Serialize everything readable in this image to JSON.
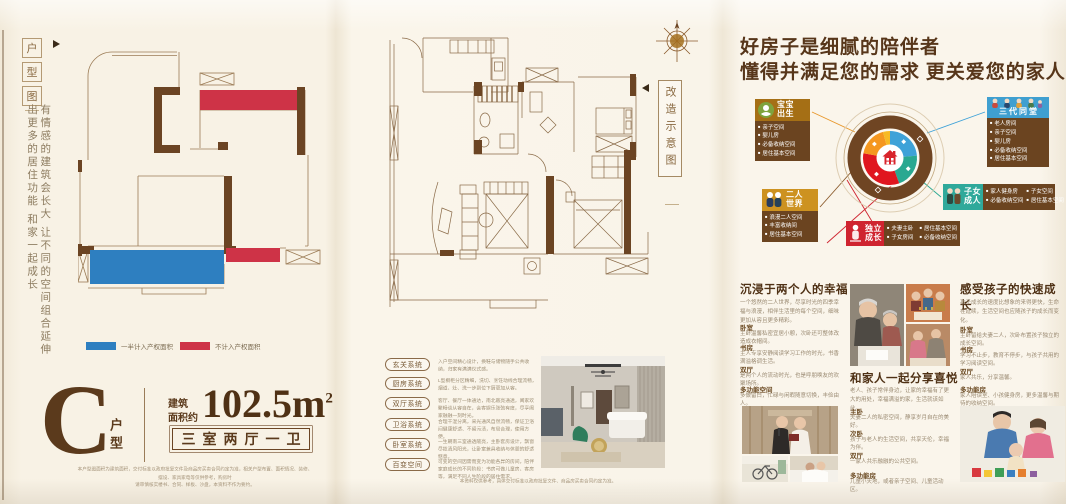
{
  "left_panel": {
    "tab_chars": [
      "户",
      "型",
      "图"
    ],
    "intro_vertical": "有情感的建筑会长大 让不同的空间组合延伸出更多的居住功能 和家一起成长",
    "legend": [
      {
        "color": "#2e7fc0",
        "label": "一半计入产权面积"
      },
      {
        "color": "#ce3347",
        "label": "不计入产权面积"
      }
    ],
    "unit_letter": "C",
    "unit_suffix": "户型",
    "area_label_1": "建筑",
    "area_label_2": "面积约",
    "area_value": "102.5m",
    "area_sup": "2",
    "rooms_label": "三室两厅一卫",
    "disclaimer_1": "本户型图面积为建筑面积，交付标准以政府批复文件及商品房买卖合同约定为准，相关户型布置、面积情况、装修、摆设、家具家电等仅供参考，购房时",
    "disclaimer_2": "请审慎核实楼书、合同、样板、沙盘，本资料不作为要约。"
  },
  "middle_panel": {
    "tab_chars": [
      "改",
      "造",
      "示",
      "意",
      "图"
    ],
    "systems": [
      {
        "name": "玄关系统",
        "desc": "入户空间精心设计，换鞋与储物随手公共收纳，归家有满满仪式感。"
      },
      {
        "name": "厨房系统",
        "desc": "L型橱柜分区精细，洗切、烹饪动线合理流畅，烟道、灶、洗一步到位下厨更加从容。"
      },
      {
        "name": "双厅系统",
        "desc": "客厅、餐厅一体通达，南北敞亮通透，阖家欢聚畅谈从容自在，会客娱乐张弛有度，尽享阖家融融一刻时光。"
      },
      {
        "name": "卫浴系统",
        "desc": "合理干湿分离，采光通风自然流畅，保证卫浴间健康舒适、不留污渍，布局合理，使用方便。"
      },
      {
        "name": "卧室系统",
        "desc": "一生朝南三室通透敞亮，主卧套房设计，飘窗尽揽清风阳光，让卧室兼具收纳与休憩的舒适惬意。"
      },
      {
        "name": "百变空间",
        "desc": "可变的空间因需而变为功能各异的房间，陪伴家庭成长的不同阶段：书房可做儿童房、客房等，满足不同人生阶段的居住需求。"
      }
    ],
    "disclaimer": "本资料仅供参考，具体交付标准以政府批复文件、商品房买卖合同约定为准。"
  },
  "right_panel": {
    "heading_1": "好房子是细腻的陪伴者",
    "heading_2": "懂得并满足您的需求 更关爱您的家人",
    "wheel_colors": {
      "ring": "#6f4523",
      "orange": "#f5971f",
      "yellow": "#f7ba24",
      "blue": "#3ea2d8",
      "teal": "#2aa891",
      "red": "#e0161f",
      "house": "#d8242c"
    },
    "stages": [
      {
        "name_1": "宝宝",
        "name_2": "出生",
        "color": "#a56f15",
        "bullets": [
          "亲子空间",
          "婴儿房",
          "必备收纳空间",
          "居住基本空间"
        ]
      },
      {
        "name_1": "三代同堂",
        "name_2": "",
        "color": "#3f9fd0",
        "bullets": [
          "老人房间",
          "亲子空间",
          "婴儿房",
          "必备收纳空间",
          "居住基本空间"
        ]
      },
      {
        "name_1": "二人",
        "name_2": "世界",
        "color": "#cd9220",
        "bullets": [
          "浪漫二人空间",
          "丰富收纳间",
          "居住基本空间"
        ]
      },
      {
        "name_1": "子女",
        "name_2": "成人",
        "color": "#2fa99b",
        "bullets": [
          "家人健身房",
          "子女空间",
          "必备收纳空间",
          "居住基本空间"
        ]
      },
      {
        "name_1": "独立",
        "name_2": "成长",
        "color": "#cf2430",
        "bullets": [
          "夫妻主卧",
          "居住基本空间",
          "子女房间",
          "必备收纳空间"
        ]
      }
    ],
    "columns": [
      {
        "title": "沉浸于两个人的幸福",
        "intro": "一个悠然的二人世界，尽享时光的四季幸福与浪漫，相伴生活里的每个空间，细味更加从容且更多精彩。",
        "sections": [
          {
            "name": "卧室",
            "desc": "主卧温馨私密宜居小憩，次卧还可整体改造成衣帽间。"
          },
          {
            "name": "书房",
            "desc": "主人专享安静阅读学习工作的时光，书香满溢格调生活。"
          },
          {
            "name": "双厅",
            "desc": "是两个人的流动时光，也是呼朋唤友的欢聚场所。"
          },
          {
            "name": "多功能空间",
            "desc": "多做留白，忙碌与闲暇随意切换，丰俭由人。"
          }
        ]
      },
      {
        "title": "和家人一起分享喜悦",
        "intro": "老人、孩子常伴身边，让家的幸福有了更大的用处，幸福满溢的家，生活就该如此。",
        "sections": [
          {
            "name": "主卧",
            "desc": "夫妻二人的私密空间，静享岁月自在的美好。"
          },
          {
            "name": "次卧",
            "desc": "孩子与老人的生活空间，共享天伦，幸福为伴。"
          },
          {
            "name": "双厅",
            "desc": "一家人共乐融融的公共空间。"
          },
          {
            "name": "多功能房",
            "desc": "儿童小天地，或者亲子空间、儿童活动区。"
          }
        ]
      },
      {
        "title": "感受孩子的快速成长",
        "intro": "孩子成长的速度比想象的来得更快，生命在延续，生活空间也应随孩子的成长而变化。",
        "sections": [
          {
            "name": "卧室",
            "desc": "主卧留给夫妻二人，次卧布置孩子独立的成长空间。"
          },
          {
            "name": "书房",
            "desc": "学习不止步，教育不停步，与孩子共用的学习阅读空间。"
          },
          {
            "name": "双厅",
            "desc": "家人共乐，分享温馨。"
          },
          {
            "name": "多功能房",
            "desc": "家人陪读室、小孩健身房，更多温馨与期待的收纳空间。"
          }
        ]
      }
    ]
  }
}
